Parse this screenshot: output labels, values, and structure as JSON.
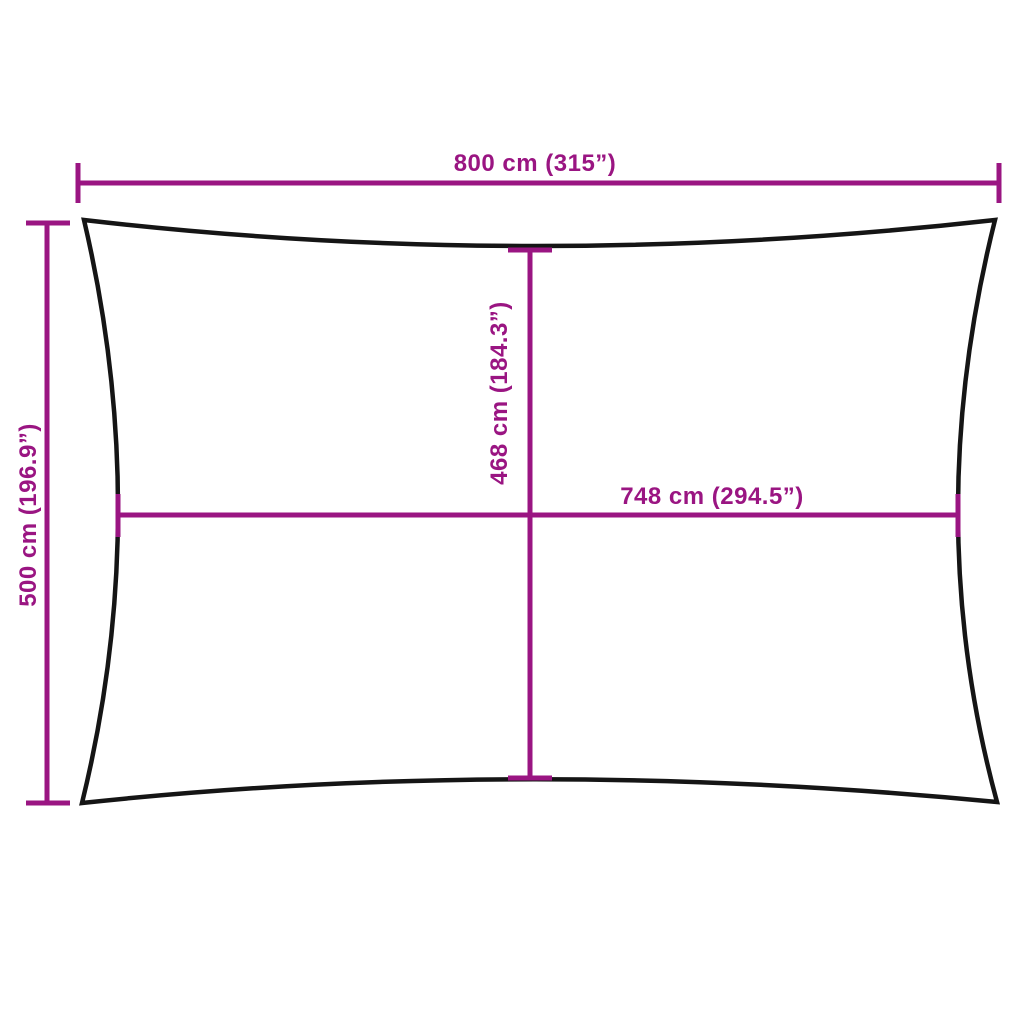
{
  "diagram": {
    "description": "Rectangular sun shade sail dimension diagram",
    "background_color": "#ffffff",
    "outline_color": "#151515",
    "dimension_color": "#9A1582",
    "measurements": {
      "overall_width": "800 cm (315”)",
      "overall_height": "500 cm (196.9”)",
      "center_height": "468 cm (184.3”)",
      "center_width": "748 cm (294.5”)"
    }
  }
}
